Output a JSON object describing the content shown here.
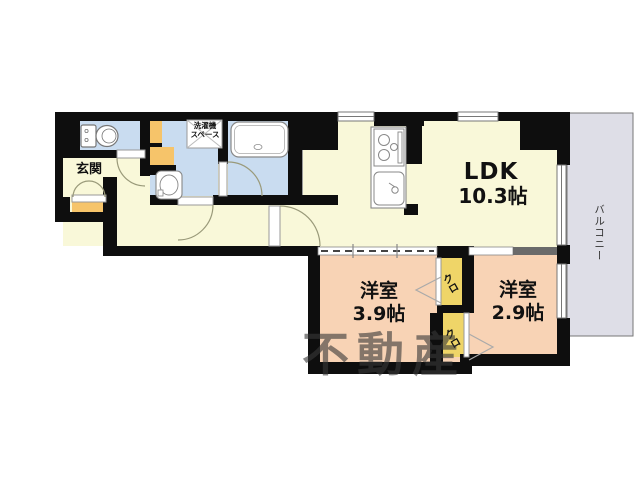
{
  "floor_plan": {
    "rooms": {
      "ldk": {
        "name": "LDK",
        "size": "10.3帖"
      },
      "bedroom_west_1": {
        "name": "洋室",
        "size": "3.9帖"
      },
      "bedroom_west_2": {
        "name": "洋室",
        "size": "2.9帖"
      },
      "entrance": {
        "name": "玄関"
      },
      "balcony": {
        "name": "バルコニー"
      },
      "laundry_space": {
        "line1": "洗濯機",
        "line2": "スペース"
      },
      "closet_upper": {
        "name": "クロ"
      },
      "closet_lower": {
        "name": "クロ"
      }
    },
    "fixtures": [
      "toilet",
      "bathtub",
      "washbasin",
      "washing-machine-space",
      "kitchen-stove",
      "kitchen-sink"
    ],
    "watermark": "不動産",
    "colors": {
      "wall": "#0e0e0e",
      "floor_hall": "#f9f8d9",
      "floor_wet": "#c9dcf0",
      "floor_bedroom": "#f8d3b5",
      "closet_yellow": "#efd568",
      "accent_orange": "#f6c46a",
      "balcony_gray": "#dedee7"
    }
  }
}
